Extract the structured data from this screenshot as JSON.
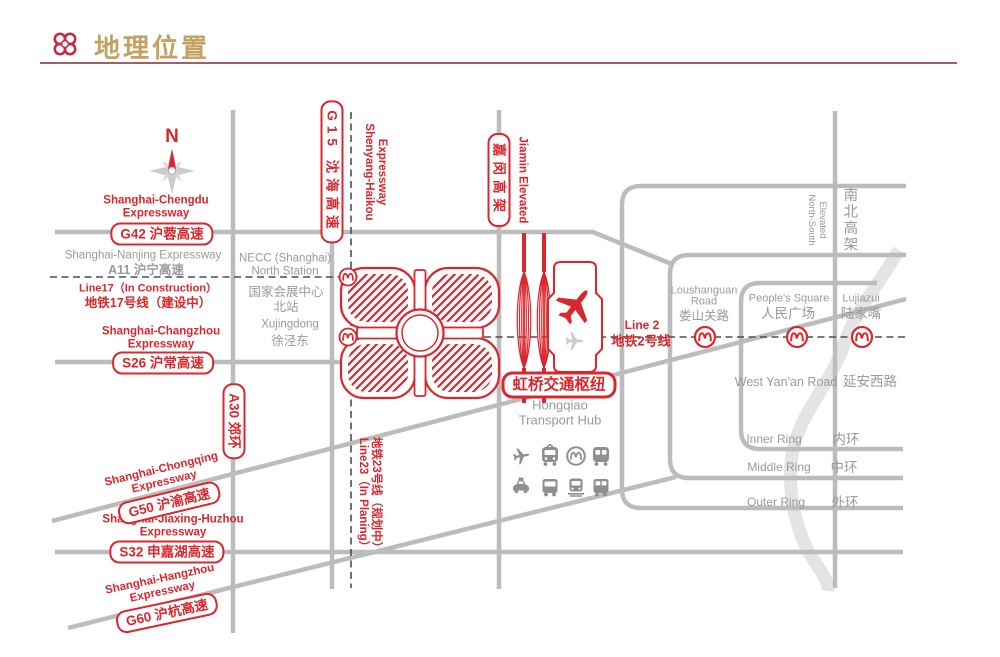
{
  "header": {
    "title": "地理位置"
  },
  "compass": {
    "north": "N"
  },
  "expressways": {
    "g42": {
      "en": [
        "Shanghai-Chengdu",
        "Expressway"
      ],
      "box": "G42 沪蓉高速"
    },
    "a11": {
      "en": "Shanghai-Nanjing Expressway",
      "code": "A11 沪宁高速"
    },
    "s26": {
      "en": [
        "Shanghai-Changzhou",
        "Expressway"
      ],
      "box": "S26 沪常高速"
    },
    "a30": {
      "box": "A30 郊环"
    },
    "g50": {
      "en": [
        "Shanghai-Chongqing",
        "Expressway"
      ],
      "box": "G50 沪渝高速"
    },
    "s32": {
      "en": [
        "Shanghai-Jiaxing-Huzhou",
        "Expressway"
      ],
      "box": "S32 申嘉湖高速"
    },
    "g60": {
      "en": [
        "Shanghai-Hangzhou",
        "Expressway"
      ],
      "box": "G60 沪杭高速"
    },
    "g15": {
      "box": "G15 沈海高速",
      "en": [
        "Shenyang-Haikou",
        "Expressway"
      ]
    },
    "jiamin": {
      "box": "嘉闵高架",
      "en": "Jiamin Elevated"
    },
    "north_south": {
      "en": [
        "North-South",
        "Elevated"
      ],
      "cn": "南北高架"
    }
  },
  "metro": {
    "line17": {
      "en": "Line17（In Construction）",
      "cn": "地铁17号线（建设中）"
    },
    "line2": {
      "en": "Line 2",
      "cn": "地铁2号线"
    },
    "line23": {
      "en": "Line23（In Planing）",
      "cn": "地铁23号线（规划中）"
    }
  },
  "places": {
    "necc": {
      "l1": "NECC (Shanghai)",
      "l2": "North Station",
      "l3": "国家会展中心",
      "l4": "北站"
    },
    "xujingdong": {
      "en": "Xujingdong",
      "cn": "徐泾东"
    },
    "loushanguan": {
      "en1": "Loushanguan",
      "en2": "Road",
      "cn": "娄山关路"
    },
    "peoples_square": {
      "en": "People's Square",
      "cn": "人民广场"
    },
    "lujiazui": {
      "en": "Lujiazui",
      "cn": "陆家嘴"
    },
    "west_yanan": {
      "en": "West Yan'an Road",
      "cn": "延安西路"
    },
    "inner_ring": {
      "en": "Inner Ring",
      "cn": "内环"
    },
    "middle_ring": {
      "en": "Middle Ring",
      "cn": "中环"
    },
    "outer_ring": {
      "en": "Outer Ring",
      "cn": "外环"
    }
  },
  "hub": {
    "box": "虹桥交通枢纽",
    "en": [
      "Hongqiao",
      "Transport Hub"
    ],
    "icons": [
      "airplane",
      "high-speed-rail",
      "metro",
      "intercity-rail",
      "taxi",
      "bus",
      "tram",
      "coach"
    ]
  },
  "colors": {
    "accent_red": "#d9272e",
    "title_gold": "#c3a15f",
    "underline_red": "#a85a66",
    "road_gray": "#bcbcbc",
    "text_gray": "#9a9a9a",
    "river_gray": "#e4e4e4"
  }
}
